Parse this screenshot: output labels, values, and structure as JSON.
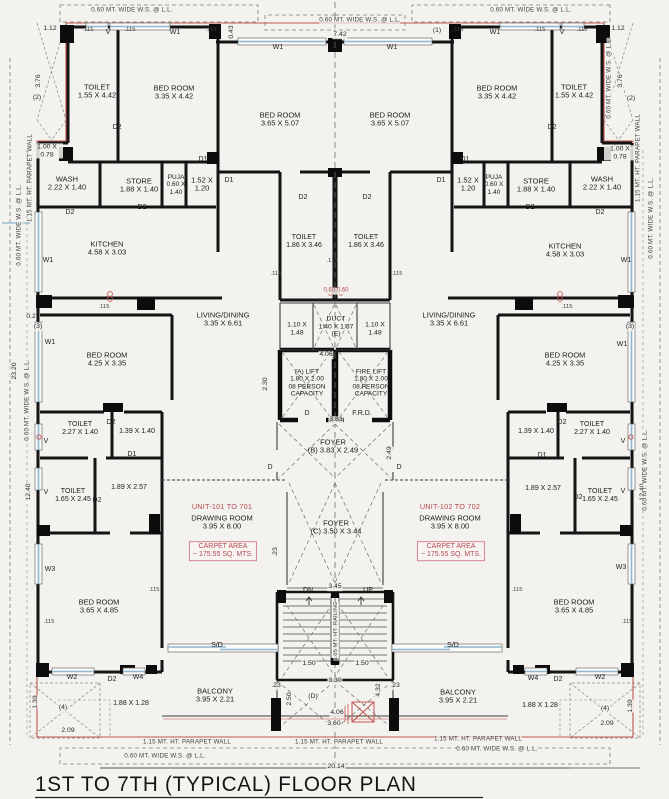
{
  "title": "1ST TO 7TH (TYPICAL) FLOOR PLAN",
  "edge": {
    "ws": "0.60 MT. WIDE W.S. @ L.L.",
    "parapet": "1.15 MT. HT. PARAPET WALL",
    "railing": "1.05 MT. HT. RAILING"
  },
  "rooms": {
    "toilet_a": {
      "name": "TOILET",
      "dim": "1.55 X 4.42"
    },
    "bed_a": {
      "name": "BED ROOM",
      "dim": "3.35 X 4.42"
    },
    "bed_b": {
      "name": "BED ROOM",
      "dim": "3.65 X 5.07"
    },
    "wash": {
      "name": "WASH",
      "dim": "2.22 X 1.40"
    },
    "store": {
      "name": "STORE",
      "dim": "1.88 X 1.40"
    },
    "puja": {
      "name": "PUJA",
      "dim": "0.60 X 1.40"
    },
    "pass_a": {
      "dim": "1.52 X 1.20"
    },
    "kitchen": {
      "name": "KITCHEN",
      "dim": "4.58 X 3.03"
    },
    "toilet_b": {
      "name": "TOILET",
      "dim": "1.86 X 3.46"
    },
    "living": {
      "name": "LIVING/DINING",
      "dim": "3.35 X 6.61"
    },
    "duct": {
      "name": "DUCT",
      "dim": "1.40 X 1.37",
      "tag": "(E)"
    },
    "duct_side": {
      "dim": "1.10 X 1.48"
    },
    "lift": {
      "name": "(A)  LIFT",
      "dim": "1.80 X 2.00",
      "l3": "08 PERSON",
      "l4": "CAPACITY"
    },
    "fire_lift": {
      "name": "FIRE LIFT",
      "dim": "1.80 X 2.00",
      "l3": "08 PERSON",
      "l4": "CAPACITY"
    },
    "bed_c": {
      "name": "BED ROOM",
      "dim": "4.25 X 3.35"
    },
    "toilet_c": {
      "name": "TOILET",
      "dim": "2.27 X 1.40"
    },
    "pass_b": {
      "dim": "1.39 X 1.40"
    },
    "foyer_b": {
      "name": "FOYER",
      "dim": "(B) 3.83 X 2.49"
    },
    "toilet_d": {
      "name": "TOILET",
      "dim": "1.65 X 2.45"
    },
    "pass_c": {
      "dim": "1.89 X 2.57"
    },
    "foyer_c": {
      "name": "FOYER",
      "dim": "(C) 3.50 X 3.44"
    },
    "bed_d": {
      "name": "BED ROOM",
      "dim": "3.65 X 4.85"
    },
    "balcony": {
      "name": "BALCONY",
      "dim": "3.95 X 2.21"
    },
    "pass_d": {
      "dim": "1.88 X 1.28"
    }
  },
  "units": {
    "left": {
      "id": "UNIT-101 TO 701",
      "room": "DRAWING ROOM",
      "dim": "3.95 X 8.00",
      "carpet1": "CARPET AREA",
      "carpet2": "~ 175.55 SQ. MTS."
    },
    "right": {
      "id": "UNIT-102 TO 702",
      "room": "DRAWING ROOM",
      "dim": "3.95 X 8.00",
      "carpet1": "CARPET AREA",
      "carpet2": "~ 175.55 SQ. MTS."
    }
  },
  "marks": {
    "w1": "W1",
    "w2": "W2",
    "w3": "W3",
    "w4": "W4",
    "v": "V",
    "d1": "D1",
    "d2": "D2",
    "sd": "S/D",
    "dn": "DN",
    "up": "UP",
    "d": "D",
    "frd": "F.R.D.",
    "t115": ".115"
  },
  "dims": {
    "d112": "1.12",
    "d376": "3.76",
    "p2": "(2)",
    "d043": "0.43",
    "p1": "(1)",
    "d742": "7.42",
    "niche": "1.00 X 0.78",
    "d02": "0.2",
    "p3": "(3)",
    "d1240": "12.40",
    "d230": "2.30",
    "d406": "4.06",
    "d383": "3.83",
    "d249": "2.49",
    "d345": "3.45",
    "d150": "1.50",
    "d330": "3.30",
    "pD": "(D)",
    "d250": "2.50",
    "d432": "4.32",
    "d360": "3.60",
    "d139": "1.39",
    "p4": "(4)",
    "d209": "2.09",
    "d23": ".23",
    "d2014": "20.14",
    "d2320": "23.20",
    "vents": "0.60  0.60"
  },
  "colors": {
    "paper": "#f3f2ee",
    "wall": "#141414",
    "thin": "#4a4a4a",
    "red_line": "#c4554f",
    "red_text": "#b24a52",
    "carpet_border": "#d4858f",
    "window_blue": "#8fb6cc",
    "dash_gray": "#7d7d7b"
  }
}
